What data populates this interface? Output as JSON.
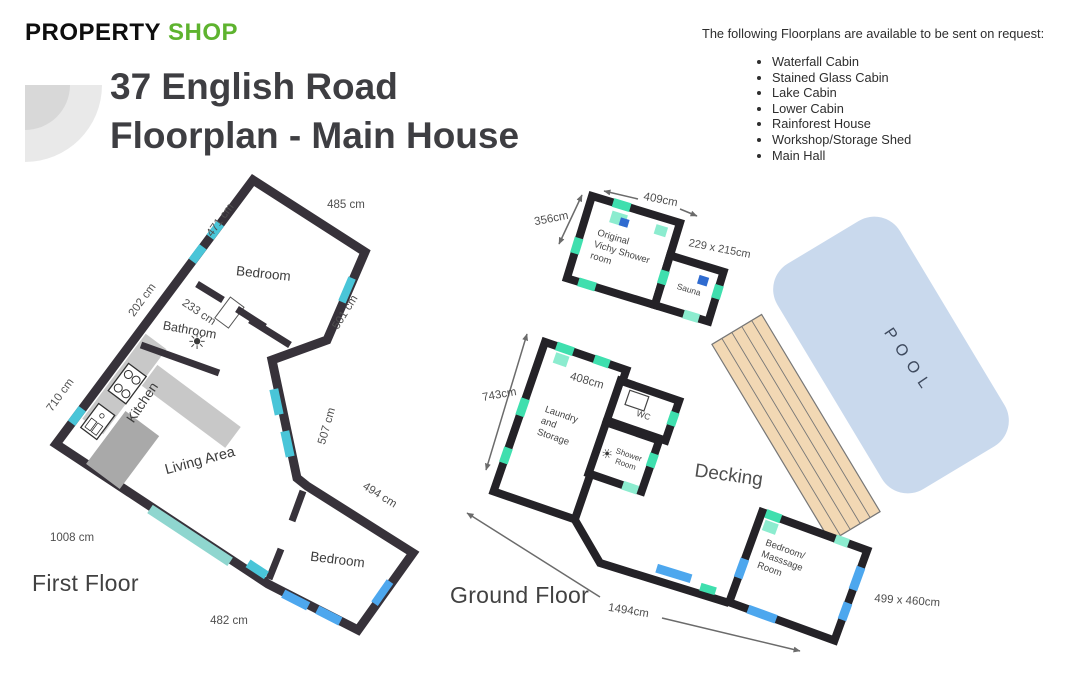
{
  "logo": {
    "word1": "PROPERTY",
    "word2": "SHOP"
  },
  "header": {
    "title_line1": "37 English Road",
    "title_line2": "Floorplan - Main House"
  },
  "request_panel": {
    "heading": "The following Floorplans are available to be sent on request:",
    "items": [
      "Waterfall Cabin",
      "Stained Glass Cabin",
      "Lake Cabin",
      "Lower Cabin",
      "Rainforest House",
      "Workshop/Storage Shed",
      "Main Hall"
    ]
  },
  "first_floor": {
    "heading": "First Floor",
    "rooms": {
      "bedroom_top": "Bedroom",
      "bathroom": "Bathroom",
      "kitchen": "Kitchen",
      "living": "Living Area",
      "bedroom_bottom": "Bedroom"
    },
    "dims": {
      "d485": "485 cm",
      "d471": "471 cm",
      "d202": "202 cm",
      "d233": "233 cm",
      "d501": "501 cm",
      "d710": "710 cm",
      "d507": "507 cm",
      "d494": "494 cm",
      "d1008": "1008 cm",
      "d482": "482 cm"
    }
  },
  "ground_floor": {
    "heading": "Ground Floor",
    "rooms": {
      "vichy": [
        "Original",
        "Vichy Shower",
        "room"
      ],
      "sauna": "Sauna",
      "laundry": [
        "Laundry",
        "and",
        "Storage"
      ],
      "wc": "WC",
      "shower": [
        "Shower",
        "Room"
      ],
      "massage": [
        "Bedroom/",
        "Masssage",
        "Room"
      ],
      "decking": "Decking",
      "pool": "POOL"
    },
    "dims": {
      "d356": "356cm",
      "d409": "409cm",
      "d229": "229 x 215cm",
      "d743": "743cm",
      "d408": "408cm",
      "d1494": "1494cm",
      "d499": "499 x 460cm"
    }
  },
  "icons": {
    "fan": "☀"
  },
  "colors": {
    "brand_green": "#5eb32f",
    "wall_dark": "#37323a",
    "window_cyan": "#49c5d8",
    "door_teal": "#3fdfae",
    "window_blue": "#4da7ee",
    "pool_blue": "#c9d9ed",
    "decking_tan": "#f2d8b4",
    "counter_gray": "#c8c8c8"
  }
}
